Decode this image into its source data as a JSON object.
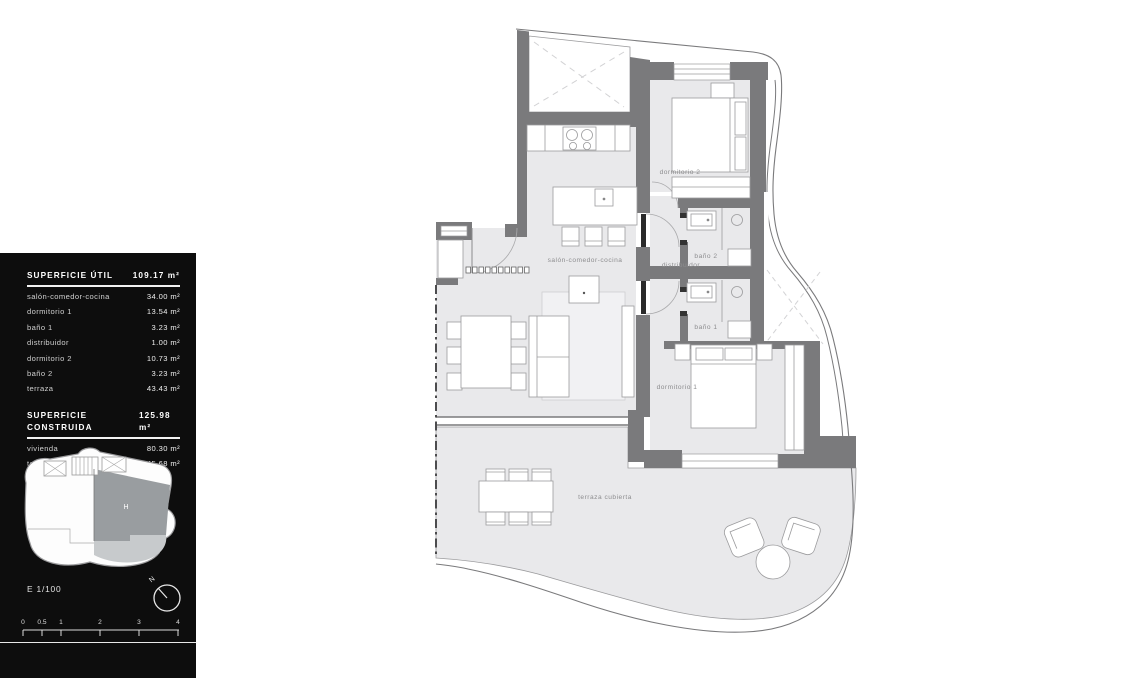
{
  "sidebar": {
    "superficie_util": {
      "title": "SUPERFICIE ÚTIL",
      "total": "109.17 m²",
      "rows": [
        {
          "label": "salón-comedor-cocina",
          "value": "34.00 m²"
        },
        {
          "label": "dormitorio 1",
          "value": "13.54 m²"
        },
        {
          "label": "baño 1",
          "value": "3.23 m²"
        },
        {
          "label": "distribuidor",
          "value": "1.00 m²"
        },
        {
          "label": "dormitorio 2",
          "value": "10.73 m²"
        },
        {
          "label": "baño 2",
          "value": "3.23 m²"
        },
        {
          "label": "terraza",
          "value": "43.43 m²"
        }
      ]
    },
    "superficie_construida": {
      "title": "SUPERFICIE CONSTRUIDA",
      "total": "125.98 m²",
      "rows": [
        {
          "label": "vivienda",
          "value": "80.30 m²"
        },
        {
          "label": "terraza",
          "value": "45.68 m²"
        }
      ]
    },
    "mini_plan": {
      "unit_label": "H"
    },
    "scale_text": "E 1/100",
    "compass_label": "N",
    "scale_bar": {
      "ticks": [
        "0",
        "0.5",
        "1",
        "2",
        "3",
        "4"
      ]
    }
  },
  "plan": {
    "rooms": {
      "salon": "salón-comedor-cocina",
      "distribuidor": "distribuidor",
      "dormitorio2": "dormitorio 2",
      "bano2": "baño 2",
      "bano1": "baño 1",
      "dormitorio1": "dormitorio 1",
      "terraza": "terraza cubierta"
    }
  },
  "colors": {
    "wall": "#7a7a7c",
    "floor": "#e9e9eb",
    "rug": "#f1f1f3",
    "sidebar_bg": "#0d0d0d",
    "label_gray": "#8d8d8f",
    "mini_unit": "#999da0",
    "mini_terrace": "#c7cacc"
  }
}
